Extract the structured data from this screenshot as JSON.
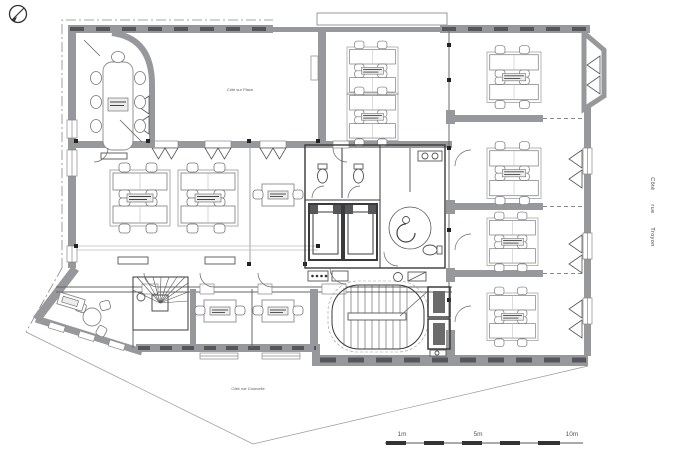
{
  "document": {
    "type": "architectural-floor-plan"
  },
  "labels": {
    "terrace": "Côté sur Place",
    "street_right": "Côté rue Troyon",
    "street_bottom": "Côté rue Courcelle"
  },
  "scale_bar": {
    "ticks": [
      "1m",
      "5m",
      "10m"
    ]
  },
  "colors": {
    "wall": "#97989b",
    "background": "#ffffff",
    "line_dark": "#3a3a3a",
    "hatch_dark": "#55565a"
  }
}
